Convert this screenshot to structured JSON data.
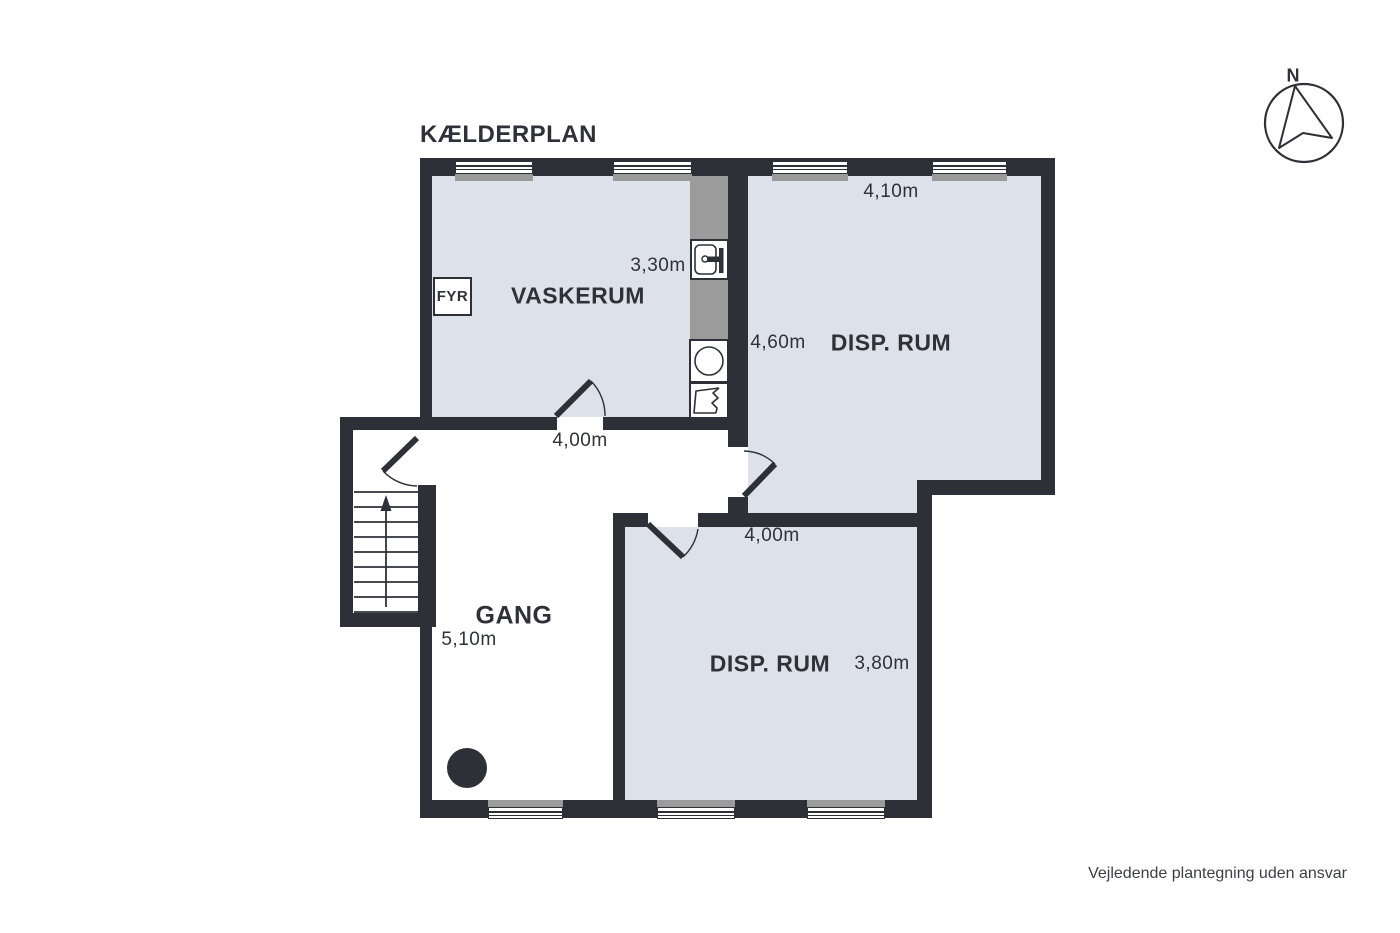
{
  "title": "KÆLDERPLAN",
  "compass": {
    "north_label": "N"
  },
  "rooms": {
    "vaskerum": {
      "label": "VASKERUM",
      "width_label": "3,30m",
      "door_width_label": "4,00m"
    },
    "disp_rum_top": {
      "label": "DISP. RUM",
      "width_label": "4,10m",
      "height_label": "4,60m"
    },
    "disp_rum_bottom": {
      "label": "DISP. RUM",
      "width_label": "4,00m",
      "height_label": "3,80m"
    },
    "gang": {
      "label": "GANG",
      "length_label": "5,10m"
    },
    "fyr": {
      "label": "FYR"
    }
  },
  "footer": "Vejledende plantegning uden ansvar",
  "colors": {
    "wall": "#2d3137",
    "room_fill": "#dde1ea",
    "fixture_gray": "#9b9b9b",
    "text_dark": "#2e3238",
    "footer_text": "#3b4046"
  }
}
